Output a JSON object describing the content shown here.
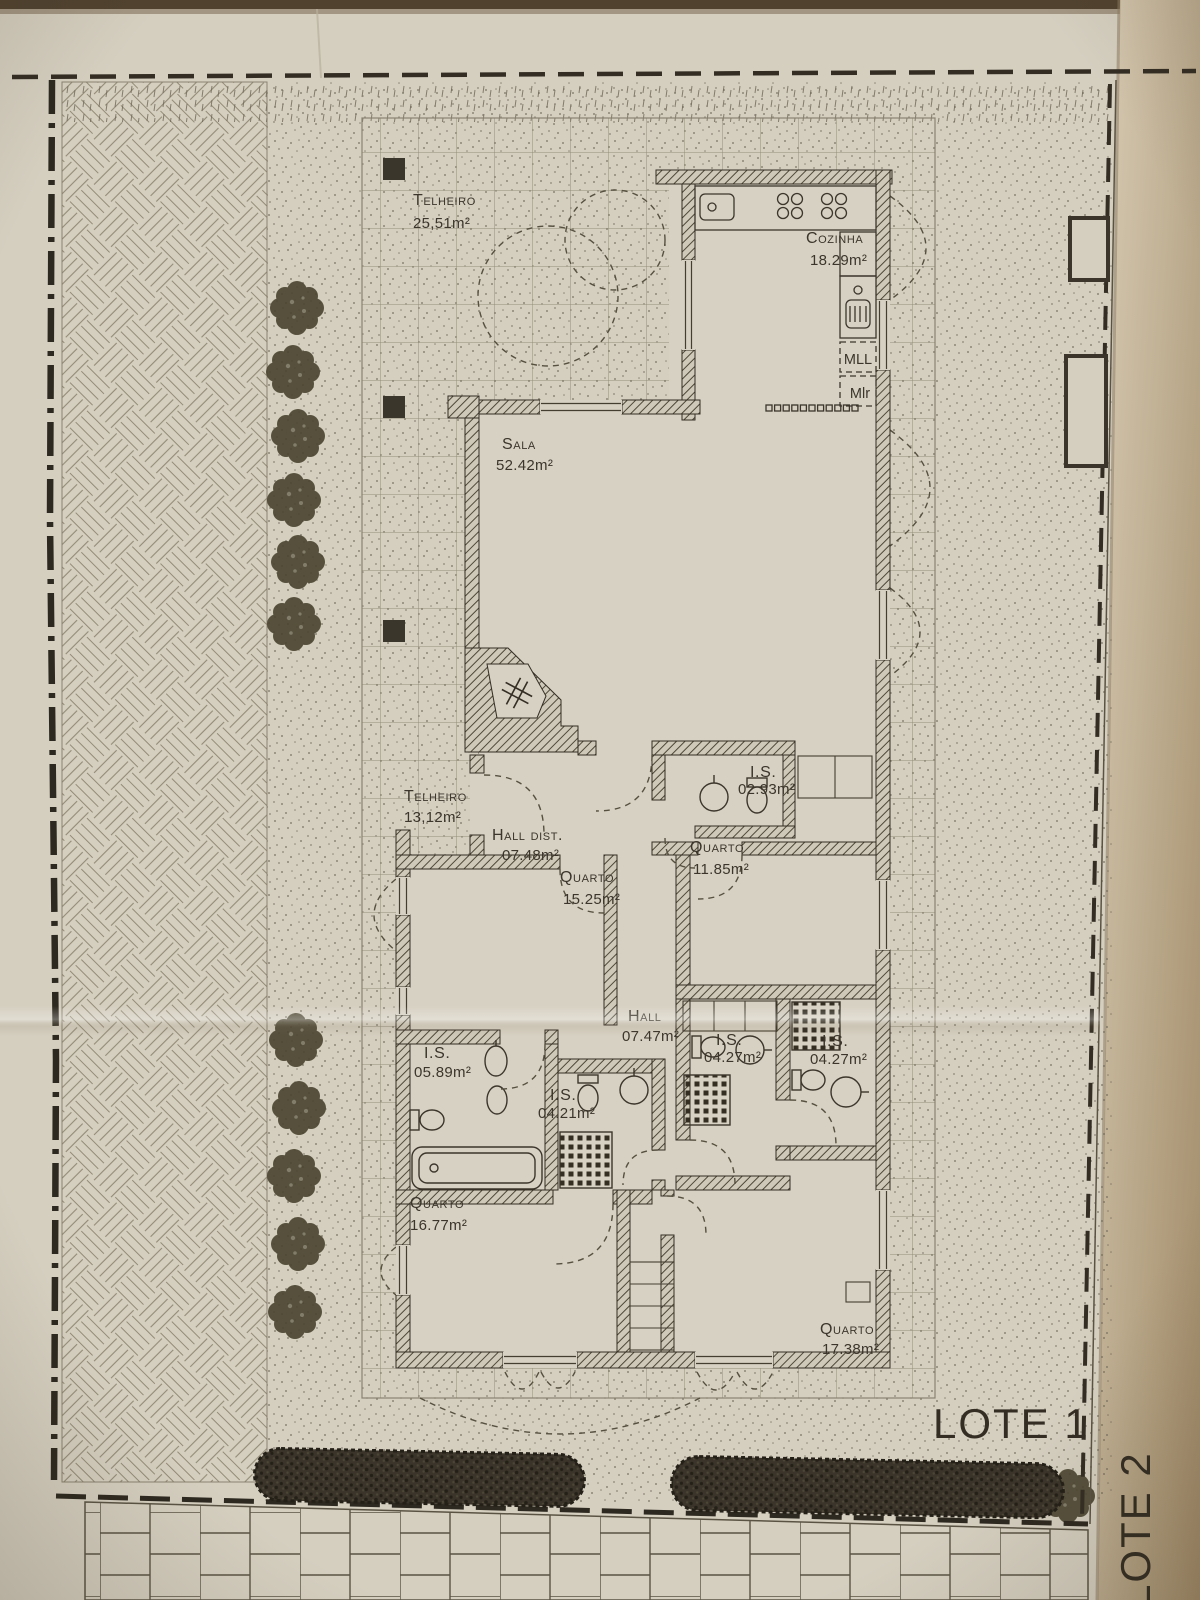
{
  "document": {
    "type": "architectural-site-plan-photo",
    "lot_labels": {
      "lote1": "LOTE 1",
      "lote2": "LOTE 2"
    },
    "colors": {
      "paper": "#d5cfc0",
      "ink": "#3b352b",
      "wall_hatch": "#4e4839",
      "photo_edge_top": "#50422f",
      "page_fold_tan": "#a8926f",
      "foliage": "#49432f"
    }
  },
  "rooms": [
    {
      "name": "Telheiro",
      "area": "25,51m²"
    },
    {
      "name": "Cozinha",
      "area": "18.29m²"
    },
    {
      "name": "Sala",
      "area": "52.42m²"
    },
    {
      "name": "Telheiro",
      "area": "13,12m²"
    },
    {
      "name": "Hall dist.",
      "area": "07.48m²"
    },
    {
      "name": "Quarto",
      "area": "15.25m²"
    },
    {
      "name": "I.S.",
      "area": "02.93m²"
    },
    {
      "name": "Quarto",
      "area": "11.85m²"
    },
    {
      "name": "Hall",
      "area": "07.47m²"
    },
    {
      "name": "I.S.",
      "area": "05.89m²"
    },
    {
      "name": "I.S.",
      "area": "04.21m²"
    },
    {
      "name": "I.S.",
      "area": "04.27m²"
    },
    {
      "name": "I.S.",
      "area": "04.27m²"
    },
    {
      "name": "Quarto",
      "area": "16.77m²"
    },
    {
      "name": "Quarto",
      "area": "17.38m²"
    }
  ],
  "appliances": {
    "dishwasher": "MLL",
    "washer": "Mlr"
  }
}
